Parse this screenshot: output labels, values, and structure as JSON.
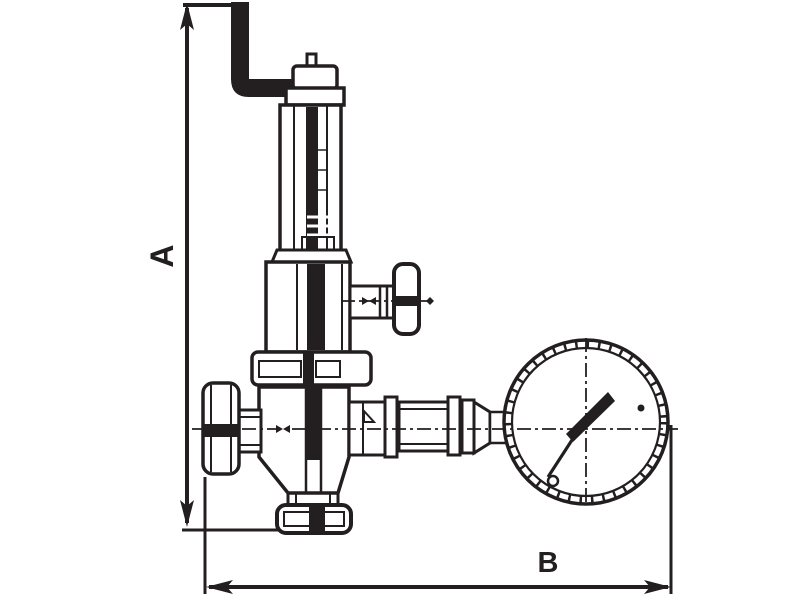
{
  "diagram": {
    "type": "technical-drawing",
    "subject": "safety relief valve with test lever and pressure gauge",
    "dimensions": {
      "a_label": "A",
      "b_label": "B"
    },
    "colors": {
      "line": "#231f20",
      "background": "#ffffff"
    },
    "components": [
      "lift-lever",
      "stem-cap",
      "spring-housing",
      "bonnet",
      "tee-handle",
      "top-flange",
      "valve-body",
      "inlet-union",
      "bottom-flange",
      "outlet-fittings",
      "pressure-gauge"
    ]
  }
}
